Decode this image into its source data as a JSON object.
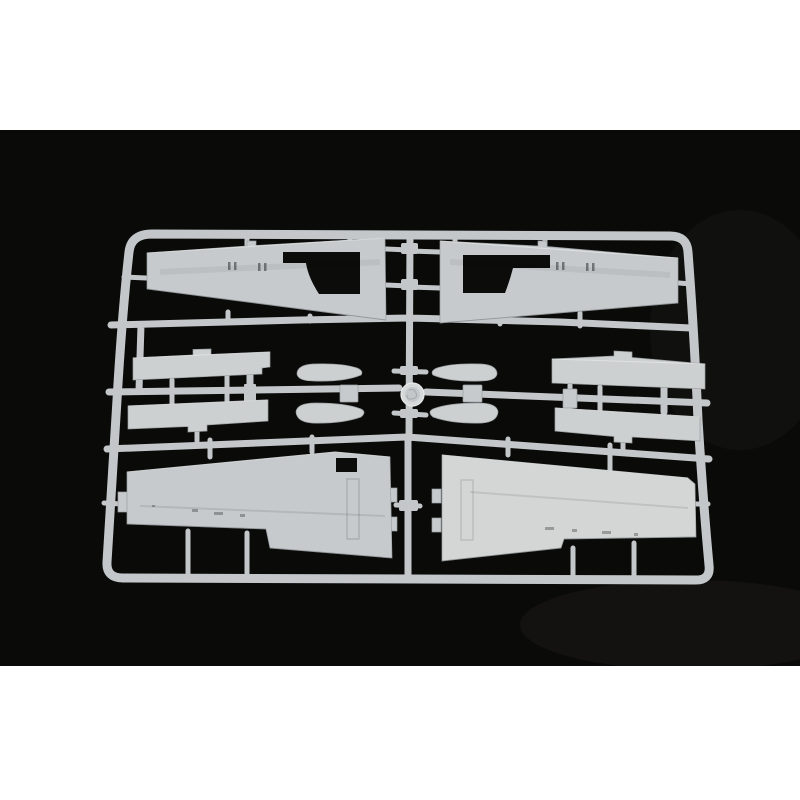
{
  "image": {
    "subject": "Photograph of a light grey injection-moulded plastic model kit sprue holding aircraft wing parts, lying on a black background between white margins"
  },
  "colors": {
    "background": "#0a0a09",
    "margin": "#ffffff",
    "runner": "#c3c7c9",
    "plastic": "#c6cacc",
    "plastic_mid": "#cdd0d1",
    "plastic_bright": "#d4d6d6",
    "hole": "#0c0c0b",
    "disc": "#d6d9da",
    "disc_inner": "#c3c7c9",
    "highlight": "#e9ebeb",
    "shadow_edge": "#868c8e"
  },
  "parts": {
    "frame": "Sprue frame",
    "runners": "Inner runner bars",
    "gates": "Sprue gates",
    "upper_wing_left": "Upper wing half - left, with wheel well opening",
    "upper_wing_right": "Upper wing half - right, with wheel well opening",
    "strip_upper_left": "Flat strip part - upper left",
    "strip_lower_left": "Flat strip part - lower left",
    "strip_upper_right": "Flat strip part - upper right",
    "strip_lower_right": "Flat strip part - lower right",
    "blade_upper_left": "Small curved part - upper left",
    "blade_lower_left": "Small curved part - lower left",
    "blade_upper_right": "Small curved part - upper right",
    "blade_lower_right": "Small curved part - lower right",
    "block_left": "Small rectangular part - left of centre",
    "block_right": "Small rectangular part - right of centre",
    "block_far_right": "Small rectangular part - far right",
    "lower_wing_left": "Lower wing half - left, with rectangular opening",
    "lower_wing_right": "Lower wing half - right",
    "center_disc": "Round mould boss with embossed logo"
  }
}
